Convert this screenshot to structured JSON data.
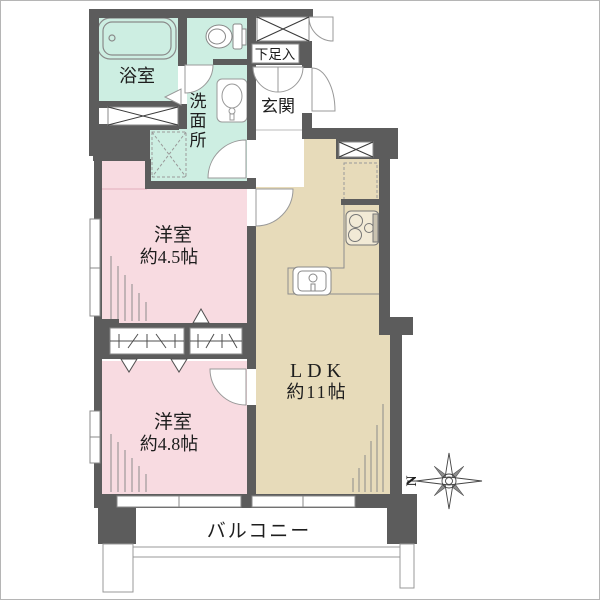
{
  "floorplan": {
    "rooms": {
      "bathroom": {
        "label": "浴室"
      },
      "washroom": {
        "label": "洗面所"
      },
      "entrance": {
        "label": "玄関"
      },
      "shoe_storage": {
        "label": "下足入"
      },
      "bedroom_1": {
        "label": "洋室",
        "size": "約4.5帖"
      },
      "bedroom_2": {
        "label": "洋室",
        "size": "約4.8帖"
      },
      "ldk": {
        "label": "LDK",
        "size": "約11帖"
      },
      "balcony": {
        "label": "バルコニー"
      }
    },
    "compass": {
      "north_label": "N"
    },
    "colors": {
      "wall": "#5c5c5c",
      "wet_area": "#cdeee2",
      "bedroom": "#f8dbe1",
      "ldk": "#e7dbba",
      "outline": "#8a8a8a",
      "text": "#1e1e1e"
    },
    "fixture_names": [
      "bathtub",
      "toilet",
      "washbasin",
      "washing-machine-space",
      "shoe-cabinet",
      "meter-box",
      "pipe-shaft",
      "storage-box",
      "refrigerator-space",
      "kitchen-stove",
      "kitchen-sink",
      "closet-left",
      "closet-right",
      "balcony-railing",
      "compass-rose"
    ]
  }
}
